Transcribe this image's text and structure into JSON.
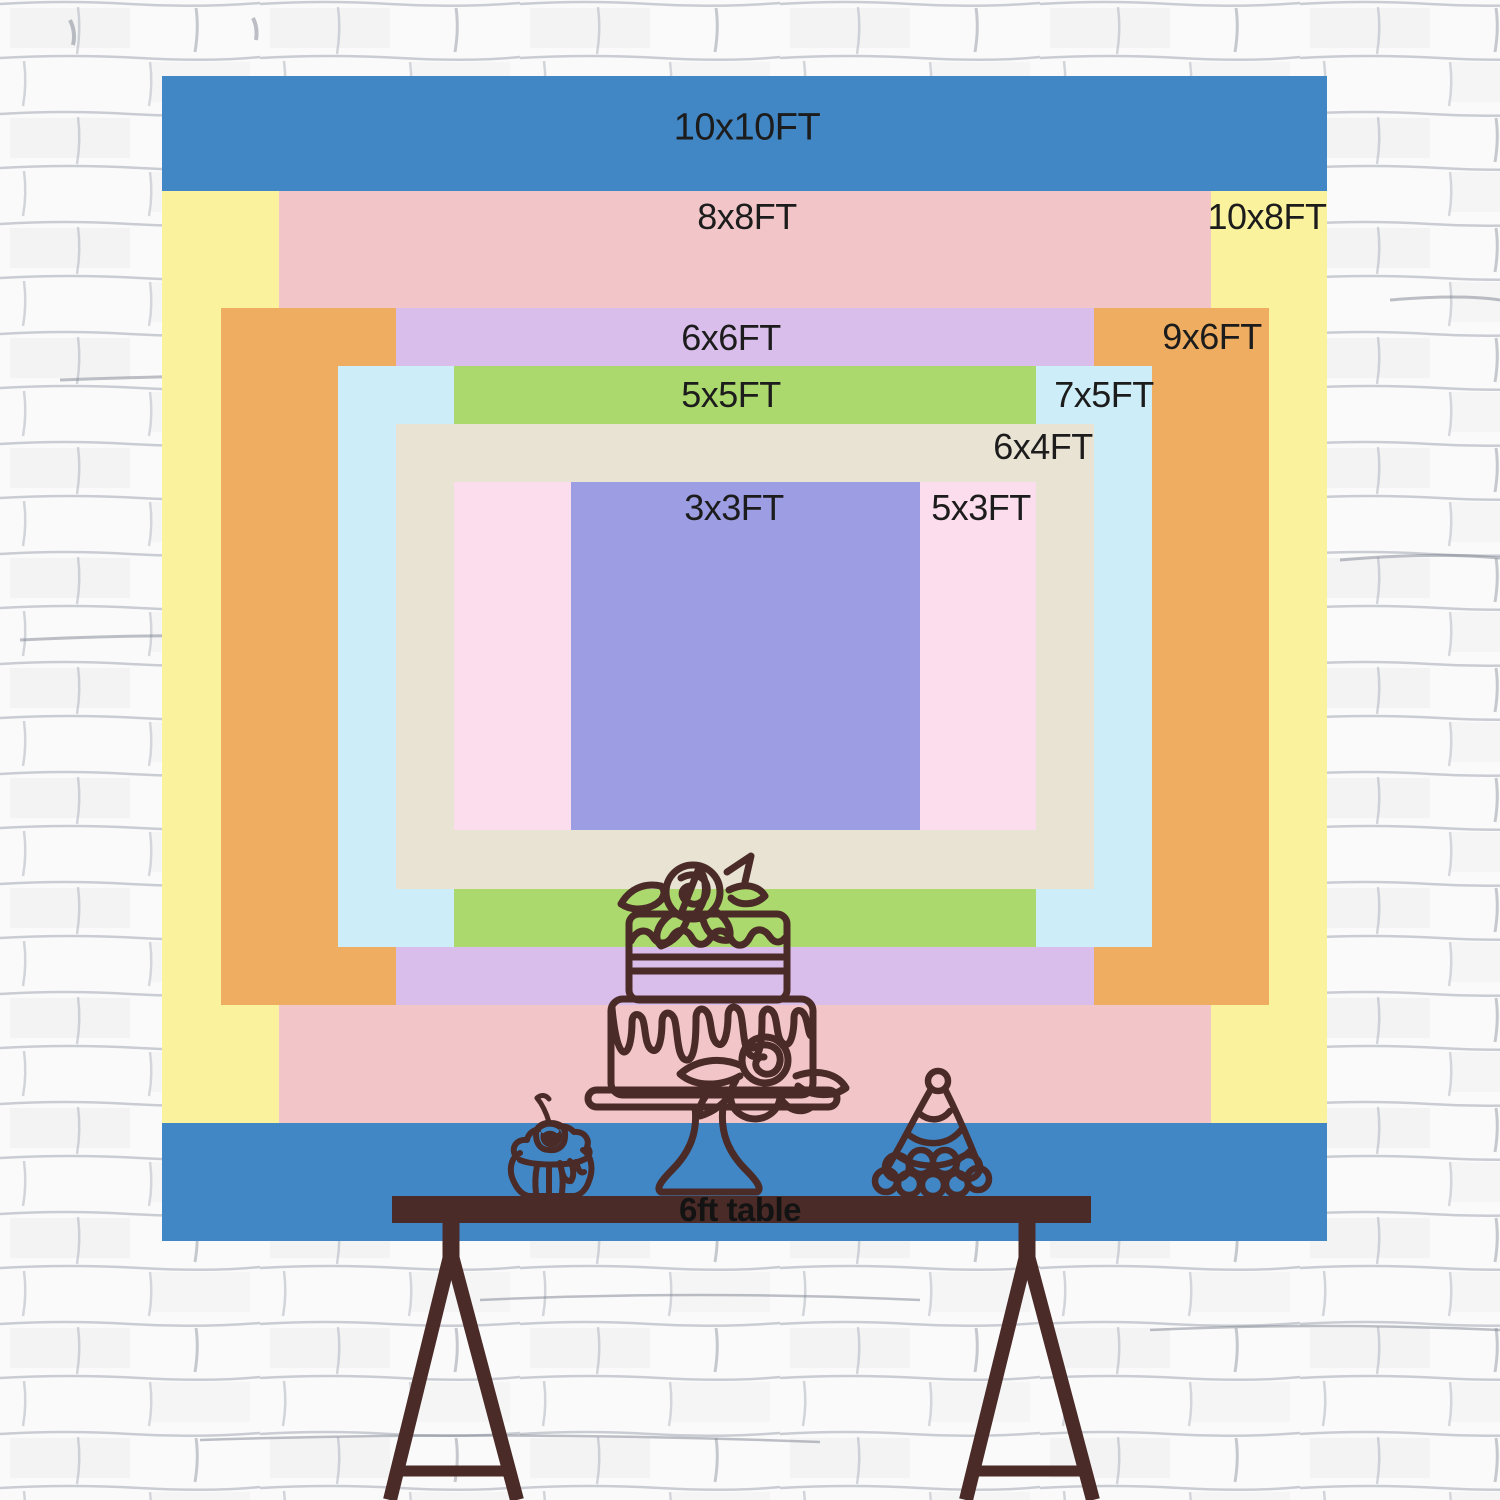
{
  "scene": {
    "description": "Backdrop size chart displayed on a white painted brick wall with a 6ft party table",
    "wall": {
      "brick_color": "#fafafa",
      "mortar_color": "#9aa0ab"
    },
    "text_color": "#1c1c1c"
  },
  "size_chart": {
    "layers": [
      {
        "label": "10x10FT",
        "color": "#4187c5"
      },
      {
        "label": "10x8FT",
        "color": "#fbf29d"
      },
      {
        "label": "8x8FT",
        "color": "#f2c6c9"
      },
      {
        "label": "9x6FT",
        "color": "#eead60"
      },
      {
        "label": "6x6FT",
        "color": "#d9bdea"
      },
      {
        "label": "7x5FT",
        "color": "#cdedf8"
      },
      {
        "label": "5x5FT",
        "color": "#acd96d"
      },
      {
        "label": "6x4FT",
        "color": "#e9e3d3"
      },
      {
        "label": "5x3FT",
        "color": "#fcddee"
      },
      {
        "label": "3x3FT",
        "color": "#9c9de3"
      }
    ]
  },
  "table": {
    "label": "6ft table",
    "color": "#4a2b27"
  },
  "decor": {
    "line_color": "#4a2b27",
    "items": [
      "two-tier drip cake with roses on pedestal stand",
      "cupcake with cherry",
      "striped party hat"
    ]
  }
}
